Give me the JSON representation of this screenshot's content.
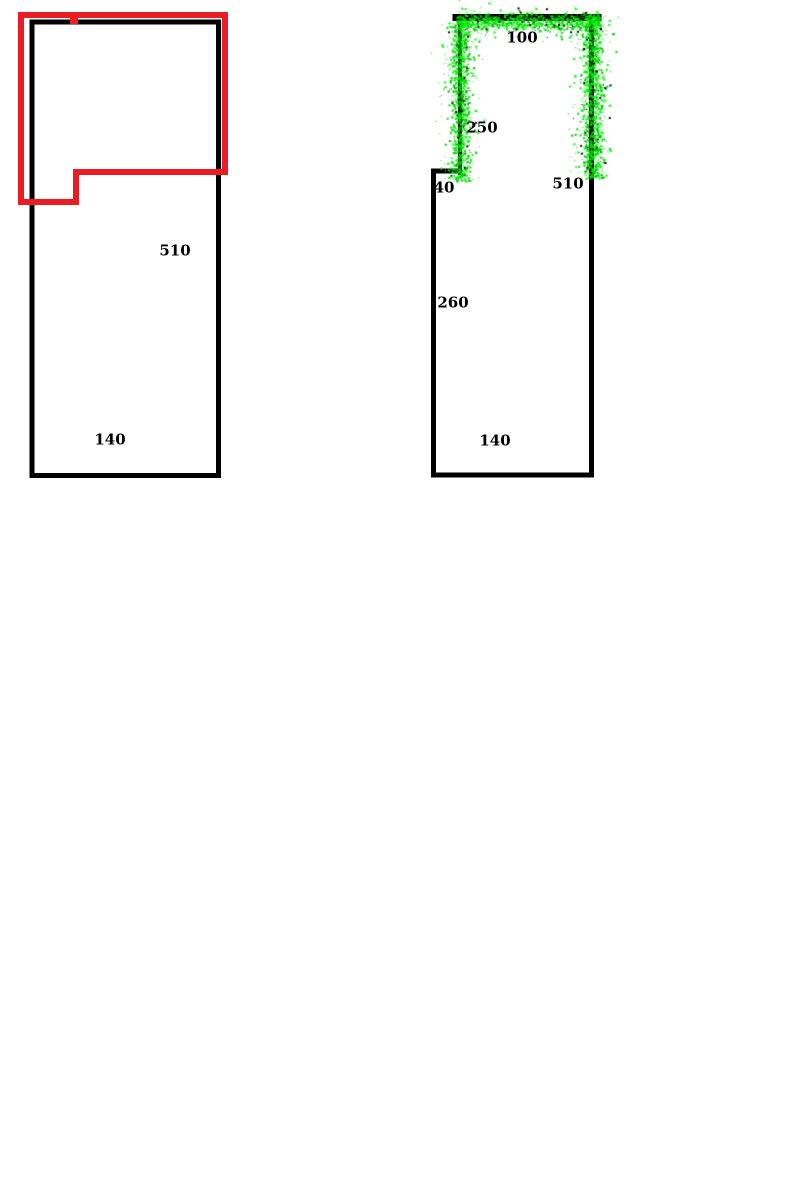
{
  "page": {
    "description": "Two floor-plan style outline drawings on a white paint canvas",
    "background_color": "#ffffff",
    "width": 800,
    "height": 1200
  },
  "colors": {
    "line_black": "#000000",
    "annotation_red": "#ec1c24",
    "spray_green_palette": [
      "#00e609",
      "#00ff00",
      "#00c000"
    ],
    "spray_speckle": "#000000"
  },
  "figures": {
    "left": {
      "description": "Room outline rectangle with red annotation outline over its upper portion",
      "room": {
        "type": "rect",
        "x": 32,
        "y": 22,
        "w": 186.5,
        "h": 453.5,
        "color": "#000000",
        "sw": 5
      },
      "red_shape": {
        "type": "polygon",
        "points": "21,15 225,15 225,172 76,172 76,202 21,202",
        "color": "#ec1c24",
        "sw": 6,
        "tick": {
          "x": 70,
          "y": 12,
          "w": 8,
          "h": 12
        }
      },
      "labels": [
        {
          "text": "510",
          "x": 175,
          "y": 251
        },
        {
          "text": "140",
          "x": 110,
          "y": 440
        }
      ]
    },
    "right": {
      "description": "Room outline with upward bay; bay walls highlighted with green spray",
      "room": {
        "type": "polyline",
        "points": "459,171 433.5,171 433.5,475 591.5,475 591.5,17",
        "color": "#000000",
        "sw": 5
      },
      "bay": {
        "type": "polyline",
        "points": "460,173 460,19 591,19 591,173",
        "color": "#000000",
        "sw": 4,
        "top": {
          "x1": 456,
          "y1": 17.5,
          "x2": 598,
          "y2": 17.5,
          "sw": 7
        }
      },
      "spray": {
        "seed": 987654321,
        "colors": [
          "#00e609",
          "#00ff00",
          "#00c000"
        ],
        "speckle": "#000000",
        "speckle_fraction": 0.06,
        "halo_fraction": 0.22,
        "segments": [
          {
            "x1": 460,
            "y1": 22,
            "x2": 460,
            "y2": 181,
            "sigma": 4.5,
            "n": 1150
          },
          {
            "x1": 456,
            "y1": 21,
            "x2": 599,
            "y2": 22,
            "sigma": 4.0,
            "n": 950
          },
          {
            "x1": 592,
            "y1": 14,
            "x2": 592,
            "y2": 178,
            "sigma": 5.0,
            "n": 1250
          }
        ]
      },
      "labels": [
        {
          "text": "100",
          "x": 522,
          "y": 38
        },
        {
          "text": "250",
          "x": 482,
          "y": 128
        },
        {
          "text": "40",
          "x": 444,
          "y": 188
        },
        {
          "text": "510",
          "x": 568,
          "y": 184
        },
        {
          "text": "260",
          "x": 453,
          "y": 303
        },
        {
          "text": "140",
          "x": 495,
          "y": 441
        }
      ]
    }
  }
}
